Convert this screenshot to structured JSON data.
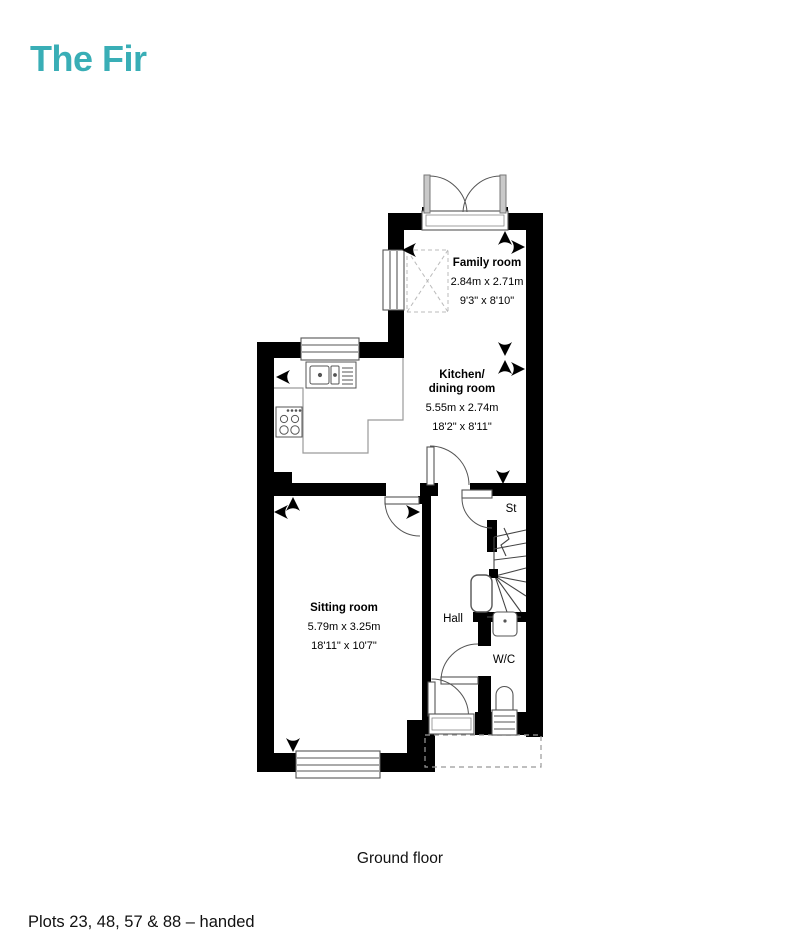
{
  "page": {
    "title": "The Fir",
    "floor_caption": "Ground floor",
    "plots_note": "Plots 23, 48, 57 & 88 – handed"
  },
  "colors": {
    "accent_teal": "#39aeb6",
    "wall_black": "#000000"
  },
  "rooms": {
    "family": {
      "name": "Family room",
      "metric": "2.84m x 2.71m",
      "imperial": "9'3\" x 8'10\""
    },
    "kitchen": {
      "name_line1": "Kitchen/",
      "name_line2": "dining room",
      "metric": "5.55m x 2.74m",
      "imperial": "18'2\" x 8'11\""
    },
    "sitting": {
      "name": "Sitting room",
      "metric": "5.79m x 3.25m",
      "imperial": "18'11\" x 10'7\""
    },
    "hall": {
      "name": "Hall"
    },
    "store": {
      "name": "St"
    },
    "wc": {
      "name": "W/C"
    }
  }
}
